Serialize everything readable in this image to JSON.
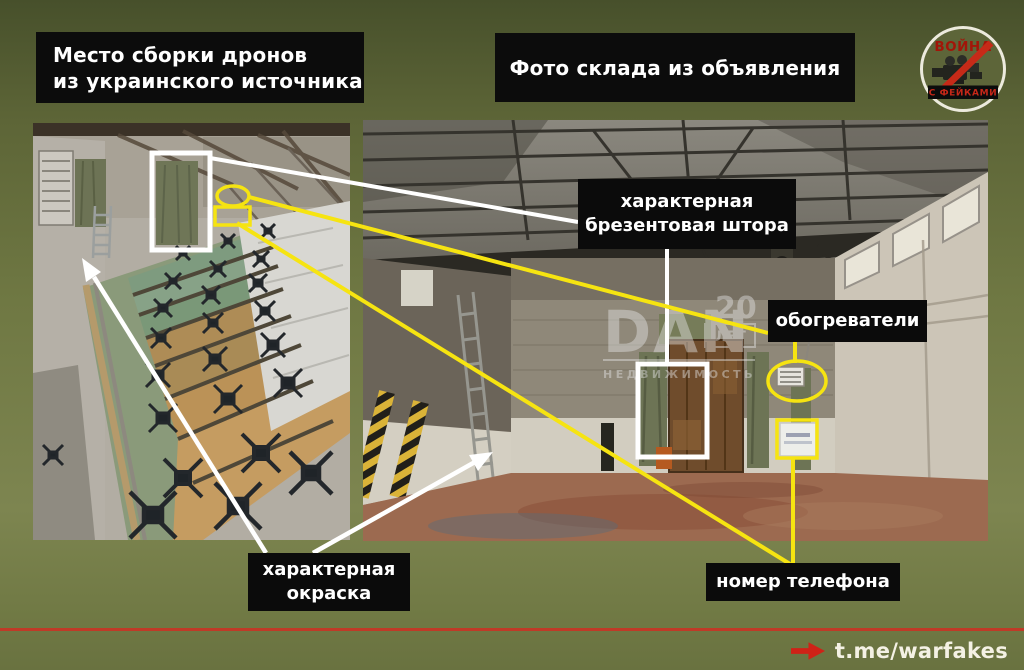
{
  "titles": {
    "left": "Место сборки дронов\nиз украинского источника",
    "right": "Фото склада из объявления"
  },
  "logo": {
    "top_text": "ВОЙНА",
    "bottom_text": "С ФЕЙКАМИ",
    "icon": "video-camera-crossed-icon"
  },
  "annotations": {
    "curtain": "характерная\nбрезентовая штора",
    "heaters": "обогреватели",
    "paint": "характерная\nокраска",
    "phone": "номер телефона"
  },
  "watermark": {
    "main": "DAN",
    "years": "20",
    "years_label": "ЛЕТ",
    "sub": "НЕДВИЖИМОСТЬ"
  },
  "footer": {
    "link": "t.me/warfakes"
  },
  "theme": {
    "background_olive": "#6f7843",
    "marker_yellow": "#f6e411",
    "marker_white": "#ffffff",
    "label_black": "#0b0b0b",
    "divider_red": "#bf3a27",
    "logo_red": "#c62718"
  }
}
